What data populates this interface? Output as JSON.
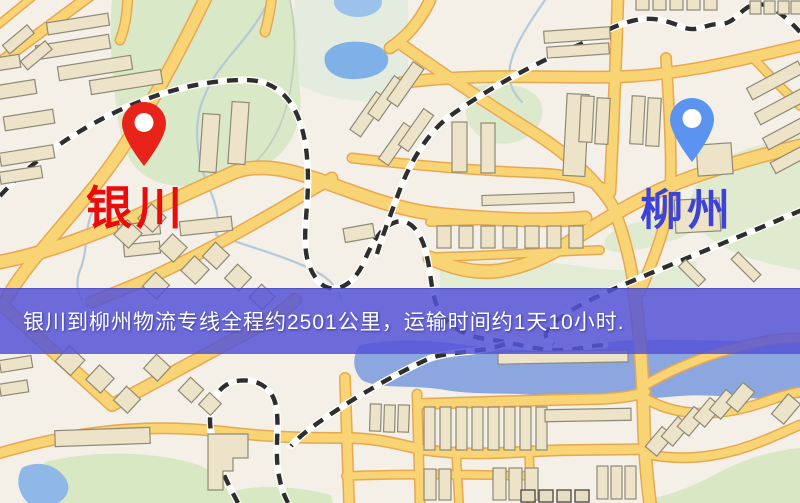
{
  "map": {
    "title": "route-map",
    "origin": {
      "label": "银川",
      "pin_color": "#e8231a",
      "label_color": "#ea0c0c"
    },
    "destination": {
      "label": "柳州",
      "pin_color": "#5b93f0",
      "label_color": "#3d43d8"
    },
    "colors": {
      "background": "#f4efe7",
      "road_fill": "#f8d474",
      "road_casing": "#e7a851",
      "water": "#8ca6e0",
      "lake": "#7fb0e8",
      "park_green": "#d9e8c6",
      "building": "#ece3c8",
      "railway_dash": "#2e2e2e"
    }
  },
  "banner": {
    "text": "银川到柳州物流专线全程约2501公里，运输时间约1天10小时.",
    "background_color": "#5553d7",
    "text_color": "#ffffff"
  }
}
